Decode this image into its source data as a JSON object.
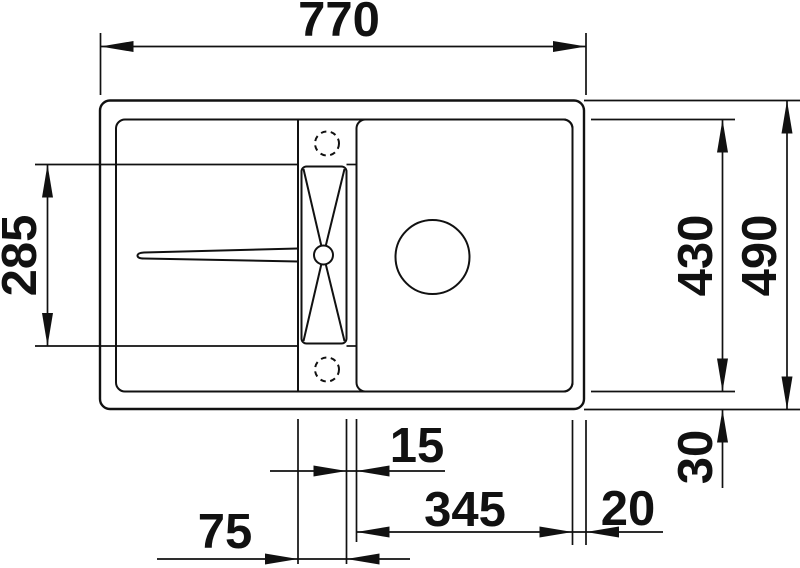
{
  "drawing": {
    "type": "sink-installation-plan-top-view",
    "colors": {
      "line": "#111111",
      "background": "#ffffff"
    },
    "dimensions": {
      "overall_width": "770",
      "left_section_depth": "285",
      "inner_depth": "430",
      "overall_depth": "490",
      "bottom_rim": "30",
      "channel_to_bowl_gap": "15",
      "bowl_width": "345",
      "right_rim": "20",
      "channel_width": "75"
    }
  }
}
